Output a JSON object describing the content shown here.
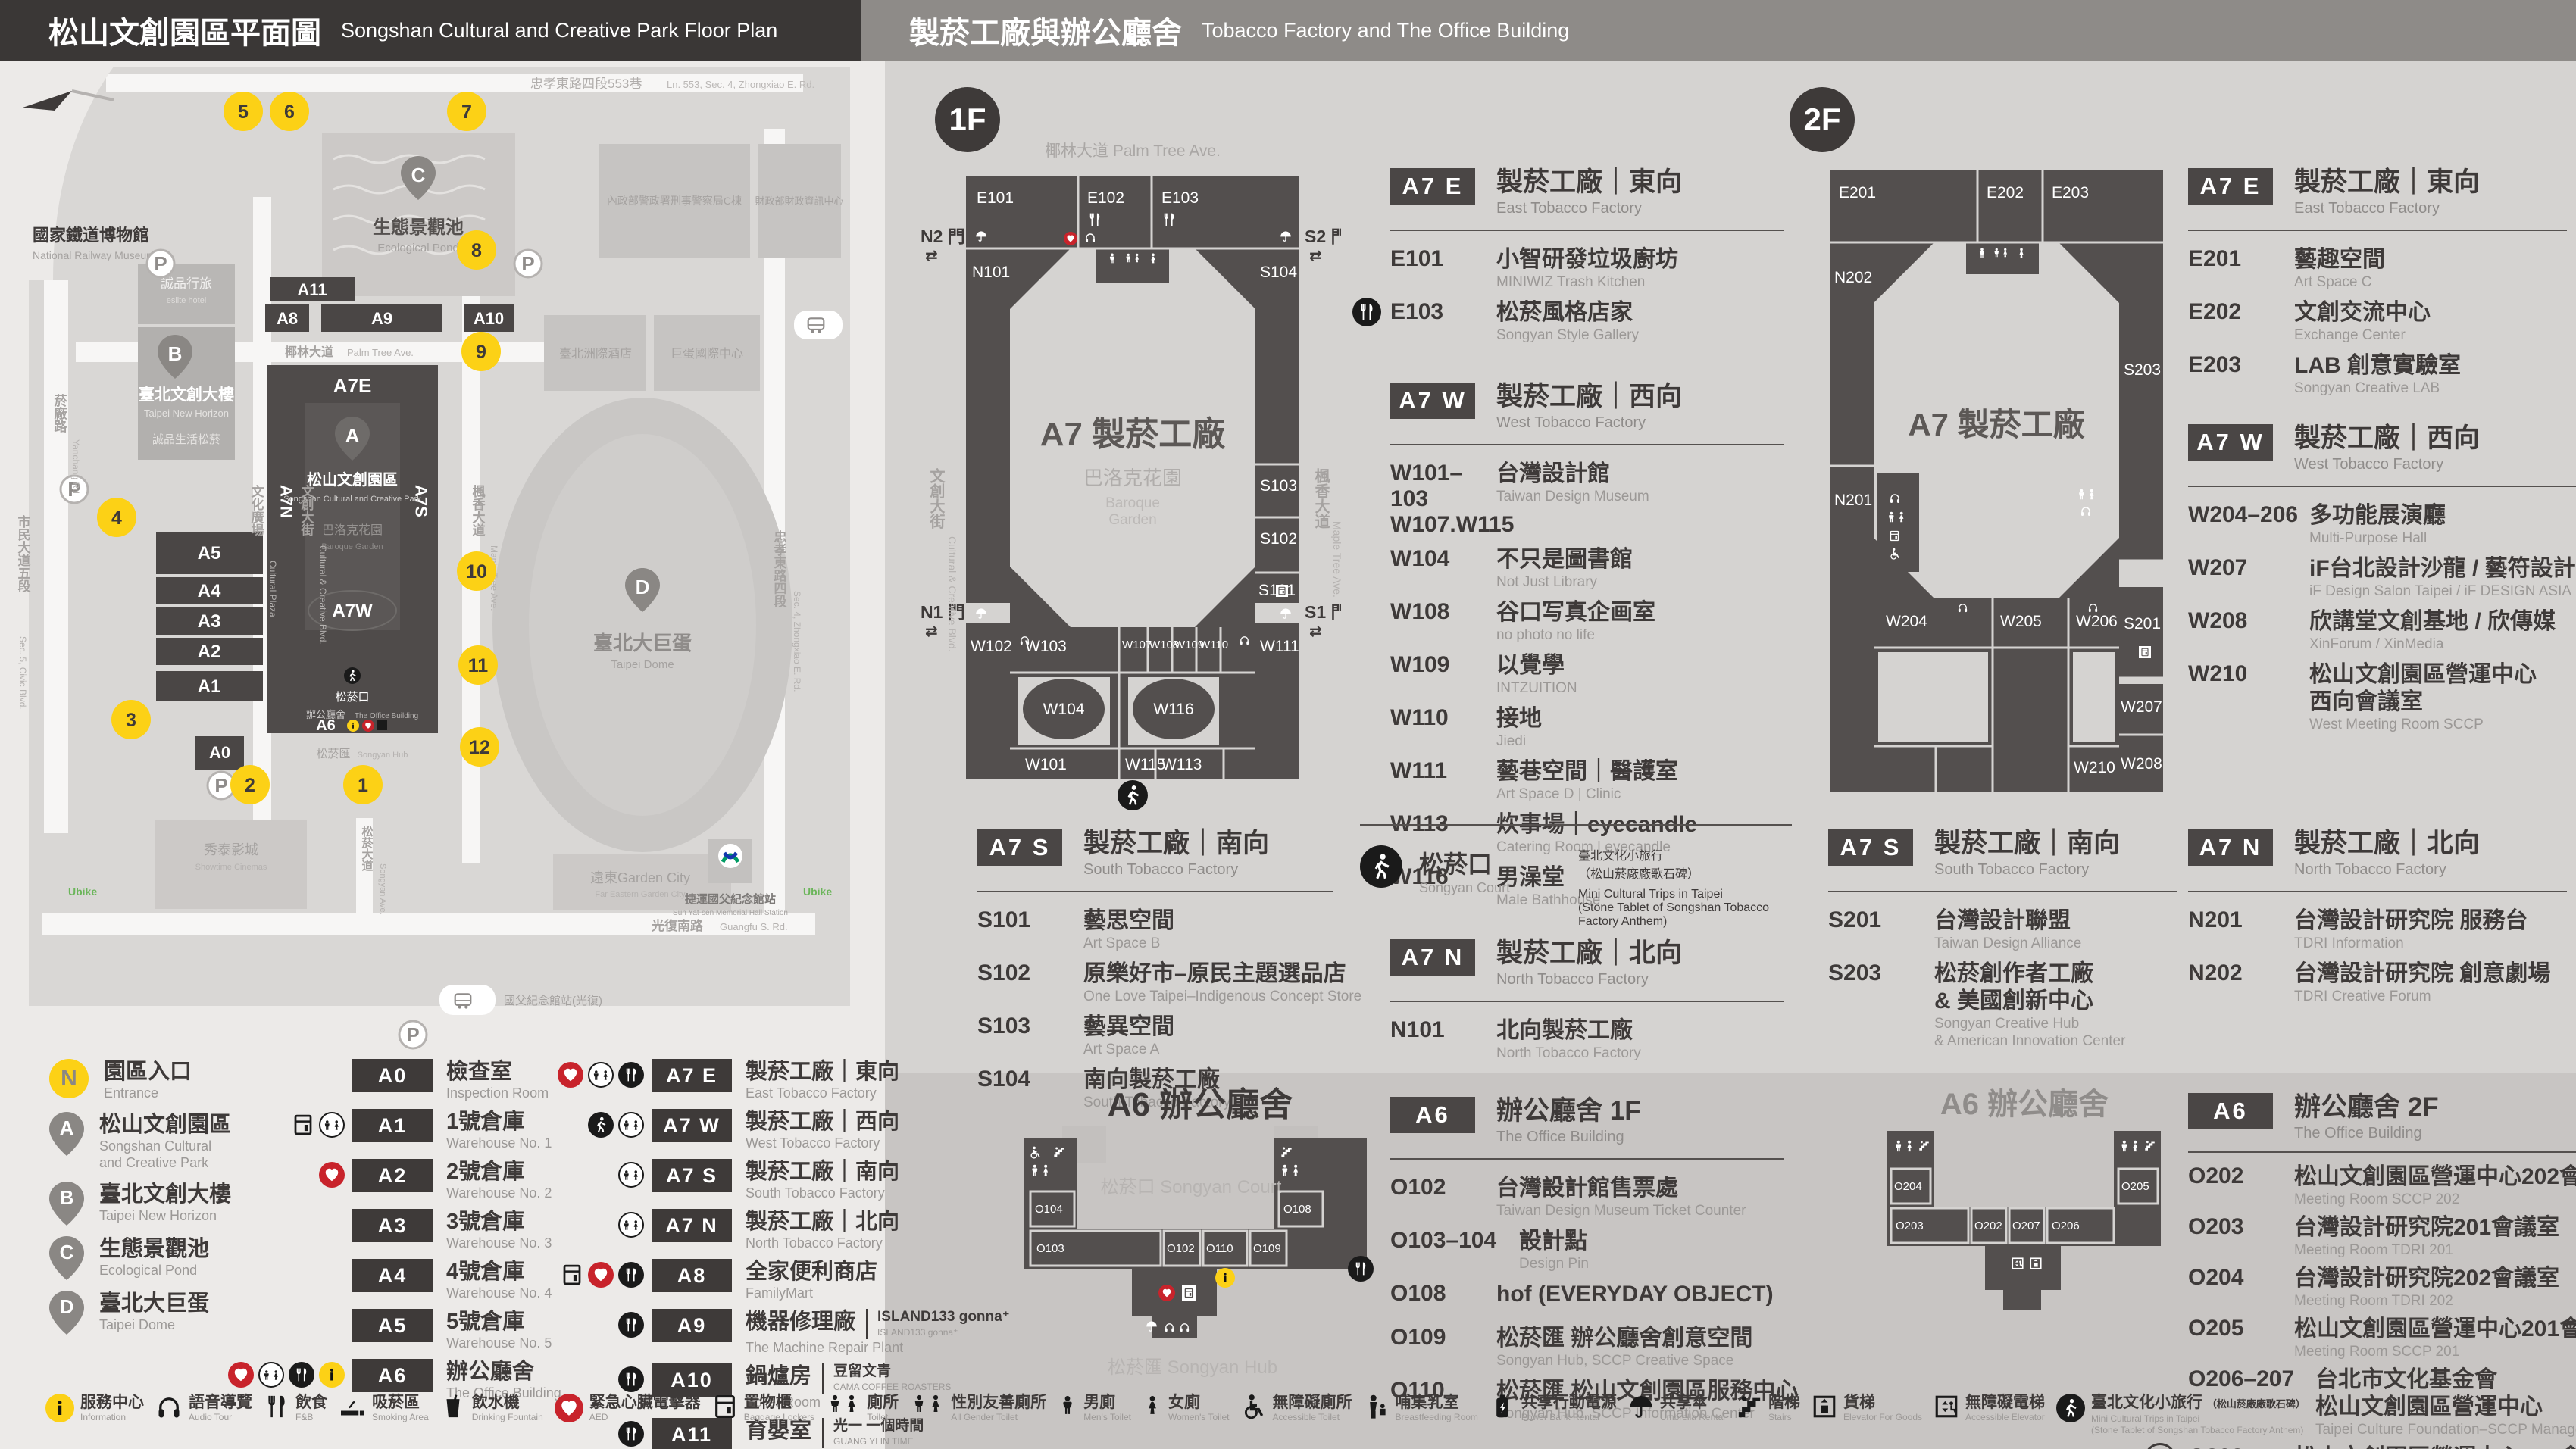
{
  "header": {
    "left": {
      "title": "松山文創園區平面圖",
      "subtitle": "Songshan Cultural and Creative Park Floor Plan"
    },
    "right": {
      "title": "製菸工廠與辦公廳舍",
      "subtitle": "Tobacco Factory and The Office Building"
    }
  },
  "park_map": {
    "railway_zh": "國家鐵道博物館",
    "railway_en": "National Railway Museum",
    "lane553_zh": "忠孝東路四段553巷",
    "lane553_en": "Ln. 553, Sec. 4, Zhongxiao E. Rd.",
    "pond_zh": "生態景觀池",
    "pond_en": "Ecological Pond",
    "newhorizon_zh": "臺北文創大樓",
    "newhorizon_en": "Taipei New Horizon",
    "eslite_hotel_zh": "誠品行旅",
    "eslite_hotel_en": "eslite hotel",
    "eslite_life_zh": "誠品生活松菸",
    "plaza_zh": "文化廣場",
    "plaza_en": "Cultural Plaza",
    "gov1_zh": "內政部警政署刑事警察局C棟",
    "gov2_zh": "財政部財政資訊中心",
    "hotel_zh": "臺北洲際酒店",
    "domectr_zh": "巨蛋國際中心",
    "palm_zh": "椰林大道",
    "palm_en": "Palm Tree Ave.",
    "ccblvd_zh": "文創大街",
    "ccblvd_en": "Cultural & Creative Blvd.",
    "maple_zh": "楓香大道",
    "maple_en": "Maple Tree Ave.",
    "park_zh": "松山文創園區",
    "park_en": "Songshan Cultural and Creative Park",
    "baroque_zh": "巴洛克花園",
    "baroque_en": "Baroque Garden",
    "court_zh": "松菸口",
    "court_en": "Songyan Court",
    "office_zh": "辦公廳舍",
    "office_en": "The Office Building",
    "hub_zh": "松菸匯",
    "hub_en": "Songyan Hub",
    "dome_zh": "臺北大巨蛋",
    "dome_en": "Taipei Dome",
    "yanchang_zh": "菸廠路",
    "yanchang_en": "Yanchang Rd.",
    "civic_zh": "市民大道五段",
    "civic_en": "Sec. 5, Civic Blvd.",
    "zhongxiao_zh": "忠孝東路四段",
    "zhongxiao_en": "Sec. 4, Zhongxiao E. Rd.",
    "guangfu_zh": "光復南路",
    "guangfu_en": "Guangfu S. Rd.",
    "songyanave_zh": "松菸大道",
    "songyanave_en": "Songyan Ave.",
    "cinema_zh": "秀泰影城",
    "cinema_en": "Showtime Cinemas",
    "garden_zh": "遠東Garden City",
    "garden_en": "Far Eastern Garden City",
    "mrt_zh": "捷運國父紀念館站",
    "mrt_en": "Sun Yat-sen Memorial Hall Station",
    "busstop_zh": "國父紀念館站(光復)",
    "ubike": "Ubike",
    "labels": {
      "a7e": "A7E",
      "a7w": "A7W",
      "a7n": "A7N",
      "a7s": "A7S",
      "a0": "A0",
      "a1": "A1",
      "a2": "A2",
      "a3": "A3",
      "a4": "A4",
      "a5": "A5",
      "a6": "A6",
      "a8": "A8",
      "a9": "A9",
      "a10": "A10",
      "a11": "A11"
    },
    "markers": {
      "a": "A",
      "b": "B",
      "c": "C",
      "d": "D"
    },
    "entrances": [
      "1",
      "2",
      "3",
      "4",
      "5",
      "6",
      "7",
      "8",
      "9",
      "10",
      "11",
      "12"
    ]
  },
  "legend": {
    "entrance": {
      "sym": "N",
      "zh": "園區入口",
      "en": "Entrance"
    },
    "places": [
      {
        "sym": "A",
        "zh": "松山文創園區",
        "en": "Songshan Cultural\nand Creative Park"
      },
      {
        "sym": "B",
        "zh": "臺北文創大樓",
        "en": "Taipei New Horizon"
      },
      {
        "sym": "C",
        "zh": "生態景觀池",
        "en": "Ecological Pond"
      },
      {
        "sym": "D",
        "zh": "臺北大巨蛋",
        "en": "Taipei Dome"
      }
    ],
    "rooms": [
      {
        "code": "A0",
        "zh": "檢查室",
        "en": "Inspection Room"
      },
      {
        "code": "A1",
        "zh": "1號倉庫",
        "en": "Warehouse No. 1"
      },
      {
        "code": "A2",
        "zh": "2號倉庫",
        "en": "Warehouse No. 2"
      },
      {
        "code": "A3",
        "zh": "3號倉庫",
        "en": "Warehouse No. 3"
      },
      {
        "code": "A4",
        "zh": "4號倉庫",
        "en": "Warehouse No. 4"
      },
      {
        "code": "A5",
        "zh": "5號倉庫",
        "en": "Warehouse No. 5"
      },
      {
        "code": "A6",
        "zh": "辦公廳舍",
        "en": "The Office Building"
      }
    ],
    "sections": [
      {
        "code": "A7 E",
        "zh": "製菸工廠｜東向",
        "en": "East Tobacco Factory"
      },
      {
        "code": "A7 W",
        "zh": "製菸工廠｜西向",
        "en": "West Tobacco Factory"
      },
      {
        "code": "A7 S",
        "zh": "製菸工廠｜南向",
        "en": "South Tobacco Factory"
      },
      {
        "code": "A7 N",
        "zh": "製菸工廠｜北向",
        "en": "North Tobacco Factory"
      },
      {
        "code": "A8",
        "zh": "全家便利商店",
        "en": "FamilyMart"
      },
      {
        "code": "A9",
        "zh": "機器修理廠",
        "en": "The Machine Repair Plant",
        "note_zh": "ISLAND133 gonna⁺",
        "note_en": "ISLAND133 gonna⁺"
      },
      {
        "code": "A10",
        "zh": "鍋爐房",
        "en": "Boiler Room",
        "note_zh": "豆留文青",
        "note_en": "CAMA COFFEE ROASTERS"
      },
      {
        "code": "A11",
        "zh": "育嬰室",
        "en": "The Nursery Room",
        "note_zh": "光一 一個時間",
        "note_en": "GUANG YI IN TIME"
      }
    ]
  },
  "facilities": [
    {
      "zh": "服務中心",
      "en": "Information"
    },
    {
      "zh": "語音導覽",
      "en": "Audio Tour"
    },
    {
      "zh": "飲食",
      "en": "F&B"
    },
    {
      "zh": "吸菸區",
      "en": "Smoking Area"
    },
    {
      "zh": "飲水機",
      "en": "Drinking Fountain"
    },
    {
      "zh": "緊急心臟電擊器",
      "en": "AED"
    },
    {
      "zh": "置物櫃",
      "en": "Baggage Lockers"
    },
    {
      "zh": "廁所",
      "en": "Toilet"
    },
    {
      "zh": "性別友善廁所",
      "en": "All Gender Toilet"
    },
    {
      "zh": "男廁",
      "en": "Men's Toilet"
    },
    {
      "zh": "女廁",
      "en": "Women's Toilet"
    },
    {
      "zh": "無障礙廁所",
      "en": "Accessible Toilet"
    },
    {
      "zh": "哺集乳室",
      "en": "Breastfeeding Room"
    },
    {
      "zh": "共享行動電源",
      "en": "Power Bank Rental"
    },
    {
      "zh": "共享傘",
      "en": "Umbrella Rental"
    },
    {
      "zh": "階梯",
      "en": "Stairs"
    },
    {
      "zh": "貨梯",
      "en": "Elevator For Goods"
    },
    {
      "zh": "無障礙電梯",
      "en": "Accessible Elevator"
    },
    {
      "zh": "臺北文化小旅行",
      "zh_note": "（松山菸廠廠歌石碑）",
      "en": "Mini Cultural Trips in Taipei",
      "en2": "(Stone Tablet of Songshan Tobacco Factory Anthem)"
    }
  ],
  "floor1": {
    "badge": "1F",
    "map": {
      "ave_top": "椰林大道  Palm Tree Ave.",
      "road_left_zh": "文創大街",
      "road_left_en": "Cultural & Creative Blvd.",
      "road_right_zh": "楓香大道",
      "road_right_en": "Maple Tree Ave.",
      "gate_n2": "N2 門",
      "gate_s2": "S2 門",
      "gate_n1": "N1 門",
      "gate_s1": "S1 門",
      "center": "A7 製菸工廠",
      "garden_zh": "巴洛克花園",
      "garden_en1": "Baroque",
      "garden_en2": "Garden",
      "rooms": {
        "e101": "E101",
        "e102": "E102",
        "e103": "E103",
        "n101": "N101",
        "s104": "S104",
        "s103": "S103",
        "s102": "S102",
        "s101": "S101",
        "w102": "W102",
        "w103": "W103",
        "w107": "W107",
        "w108": "W108",
        "w109": "W109",
        "w110": "W110",
        "w111": "W111",
        "w104": "W104",
        "w116": "W116",
        "w101": "W101",
        "w115": "W115",
        "w113": "W113"
      }
    },
    "sec_e": {
      "code": "A7 E",
      "zh": "製菸工廠｜東向",
      "en": "East Tobacco Factory",
      "items": [
        {
          "code": "E101",
          "zh": "小智研發垃圾廚坊",
          "en": "MINIWIZ Trash Kitchen"
        },
        {
          "code": "E103",
          "zh": "松菸風格店家",
          "en": "Songyan Style Gallery"
        }
      ]
    },
    "sec_w": {
      "code": "A7 W",
      "zh": "製菸工廠｜西向",
      "en": "West Tobacco Factory",
      "items": [
        {
          "code": "W101–103",
          "code2": "W107.W115",
          "zh": "台灣設計館",
          "en": "Taiwan Design Museum"
        },
        {
          "code": "W104",
          "zh": "不只是圖書館",
          "en": "Not Just Library"
        },
        {
          "code": "W108",
          "zh": "谷口写真企画室",
          "en": "no photo no life"
        },
        {
          "code": "W109",
          "zh": "以覺學",
          "en": "INTZUITION"
        },
        {
          "code": "W110",
          "zh": "接地",
          "en": "Jiedi"
        },
        {
          "code": "W111",
          "zh": "藝巷空間｜醫護室",
          "en": "Art Space D | Clinic"
        },
        {
          "code": "W113",
          "zh": "炊事場｜eyecandle",
          "en": "Catering Room | eyecandle"
        },
        {
          "code": "W116",
          "zh": "男澡堂",
          "en": "Male Bathhouse"
        }
      ]
    },
    "sec_s": {
      "code": "A7 S",
      "zh": "製菸工廠｜南向",
      "en": "South Tobacco Factory",
      "items": [
        {
          "code": "S101",
          "zh": "藝思空間",
          "en": "Art Space B"
        },
        {
          "code": "S102",
          "zh": "原樂好市–原民主題選品店",
          "en": "One Love Taipei–Indigenous Concept Store"
        },
        {
          "code": "S103",
          "zh": "藝異空間",
          "en": "Art Space A"
        },
        {
          "code": "S104",
          "zh": "南向製菸工廠",
          "en": "South Tobacco Factory"
        }
      ]
    },
    "court": {
      "zh": "松菸口",
      "en": "Songyan Court",
      "item_zh1": "臺北文化小旅行",
      "item_zh2": "（松山菸廠廠歌石碑）",
      "item_en1": "Mini Cultural Trips in Taipei",
      "item_en2": "(Stone Tablet of Songshan Tobacco Factory Anthem)"
    },
    "sec_n": {
      "code": "A7 N",
      "zh": "製菸工廠｜北向",
      "en": "North Tobacco Factory",
      "items": [
        {
          "code": "N101",
          "zh": "北向製菸工廠",
          "en": "North Tobacco Factory"
        }
      ]
    }
  },
  "floor2": {
    "badge": "2F",
    "map": {
      "center": "A7 製菸工廠",
      "rooms": {
        "e201": "E201",
        "e202": "E202",
        "e203": "E203",
        "n202": "N202",
        "n201": "N201",
        "s203": "S203",
        "s201": "S201",
        "w204": "W204",
        "w205": "W205",
        "w206": "W206",
        "w207": "W207",
        "w208": "W208",
        "w210": "W210"
      }
    },
    "sec_e": {
      "code": "A7 E",
      "zh": "製菸工廠｜東向",
      "en": "East Tobacco Factory",
      "items": [
        {
          "code": "E201",
          "zh": "藝趣空間",
          "en": "Art Space C"
        },
        {
          "code": "E202",
          "zh": "文創交流中心",
          "en": "Exchange Center"
        },
        {
          "code": "E203",
          "zh": "LAB 創意實驗室",
          "en": "Songyan Creative LAB"
        }
      ]
    },
    "sec_w": {
      "code": "A7 W",
      "zh": "製菸工廠｜西向",
      "en": "West Tobacco Factory",
      "items": [
        {
          "code": "W204–206",
          "zh": "多功能展演廳",
          "en": "Multi-Purpose Hall"
        },
        {
          "code": "W207",
          "zh": "iF台北設計沙龍 / 藝符設計",
          "en": "iF Design Salon Taipei / iF DESIGN ASIA"
        },
        {
          "code": "W208",
          "zh": "欣講堂文創基地 / 欣傳媒",
          "en": "XinForum / XinMedia"
        },
        {
          "code": "W210",
          "zh": "松山文創園區營運中心",
          "zh2": "西向會議室",
          "en": "West Meeting Room SCCP"
        }
      ]
    },
    "sec_s": {
      "code": "A7 S",
      "zh": "製菸工廠｜南向",
      "en": "South Tobacco Factory",
      "items": [
        {
          "code": "S201",
          "zh": "台灣設計聯盟",
          "en": "Taiwan Design Alliance"
        },
        {
          "code": "S203",
          "zh": "松菸創作者工廠",
          "zh2": "& 美國創新中心",
          "en": "Songyan Creative Hub",
          "en2": "& American Innovation Center"
        }
      ]
    },
    "sec_n": {
      "code": "A7 N",
      "zh": "製菸工廠｜北向",
      "en": "North Tobacco Factory",
      "items": [
        {
          "code": "N201",
          "zh": "台灣設計研究院 服務台",
          "en": "TDRI Information"
        },
        {
          "code": "N202",
          "zh": "台灣設計研究院 創意劇場",
          "en": "TDRI Creative Forum"
        }
      ]
    }
  },
  "office1f": {
    "code": "A6",
    "zh": "辦公廳舍 1F",
    "en": "The Office Building",
    "map_title": "A6 辦公廳舍",
    "map_court": "松菸口  Songyan Court",
    "map_hub": "松菸匯  Songyan Hub",
    "rooms": {
      "o104": "O104",
      "o103": "O103",
      "o102": "O102",
      "o110": "O110",
      "o109": "O109",
      "o108": "O108"
    },
    "items": [
      {
        "code": "O102",
        "zh": "台灣設計館售票處",
        "en": "Taiwan Design Museum Ticket Counter"
      },
      {
        "code": "O103–104",
        "zh": "設計點",
        "en": "Design Pin"
      },
      {
        "code": "O108",
        "zh": "hof (EVERYDAY OBJECT)",
        "en": ""
      },
      {
        "code": "O109",
        "zh": "松菸匯 辦公廳舍創意空間",
        "en": "Songyan Hub, SCCP Creative Space"
      },
      {
        "code": "O110",
        "zh": "松菸匯 松山文創園區服務中心",
        "en": "Songyan Hub, SCCP Information Center"
      }
    ]
  },
  "office2f": {
    "code": "A6",
    "zh": "辦公廳舍 2F",
    "en": "The Office Building",
    "map_title": "A6 辦公廳舍",
    "rooms": {
      "o204": "O204",
      "o205": "O205",
      "o203": "O203",
      "o202": "O202",
      "o207": "O207",
      "o206": "O206"
    },
    "items": [
      {
        "code": "O202",
        "zh": "松山文創園區營運中心202會議室",
        "en": "Meeting Room SCCP 202"
      },
      {
        "code": "O203",
        "zh": "台灣設計研究院201會議室",
        "en": "Meeting Room TDRI 201"
      },
      {
        "code": "O204",
        "zh": "台灣設計研究院202會議室",
        "en": "Meeting Room TDRI 202"
      },
      {
        "code": "O205",
        "zh": "松山文創園區營運中心201會議室",
        "en": "Meeting Room SCCP 201"
      },
      {
        "code": "O206–207",
        "zh": "台北市文化基金會",
        "zh2": "松山文創園區營運中心",
        "en": "Taipei Culture Foundation–SCCP Management Center"
      },
      {
        "code": "O302",
        "floor": "3F",
        "zh": "松山文創園區營運中心301會議室",
        "en": "Meeting Room SCCP 301"
      }
    ]
  }
}
